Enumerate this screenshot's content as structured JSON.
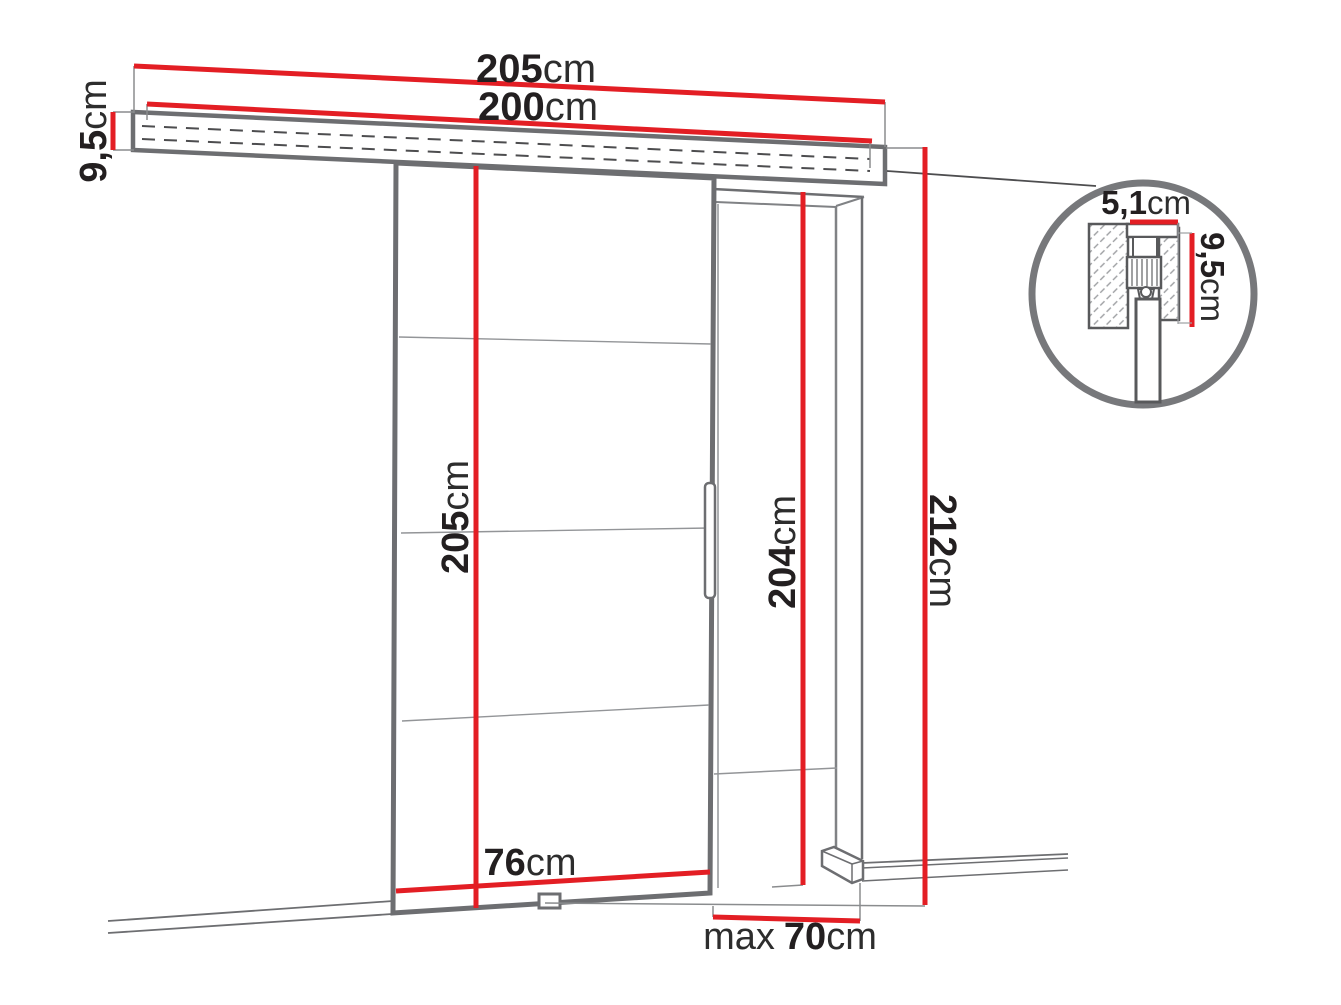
{
  "diagram": {
    "type": "sliding-door-dimension-diagram",
    "labels": {
      "rail_total": {
        "num": "205",
        "unit": "cm"
      },
      "rail_inner": {
        "num": "200",
        "unit": "cm"
      },
      "rail_height": {
        "num": "9,5",
        "unit": "cm"
      },
      "door_height": {
        "num": "205",
        "unit": "cm"
      },
      "door_width": {
        "num": "76",
        "unit": "cm"
      },
      "opening_height": {
        "num": "204",
        "unit": "cm"
      },
      "total_height": {
        "num": "212",
        "unit": "cm"
      },
      "opening_width": {
        "prefix": "max",
        "num": "70",
        "unit": "cm"
      },
      "detail_track_width": {
        "num": "5,1",
        "unit": "cm"
      },
      "detail_track_height": {
        "num": "9,5",
        "unit": "cm"
      }
    },
    "colors": {
      "dimension_red": "#e31e24",
      "outline_gray": "#6d6e71",
      "thin_gray": "#8a8c8e",
      "text": "#231f20"
    }
  }
}
